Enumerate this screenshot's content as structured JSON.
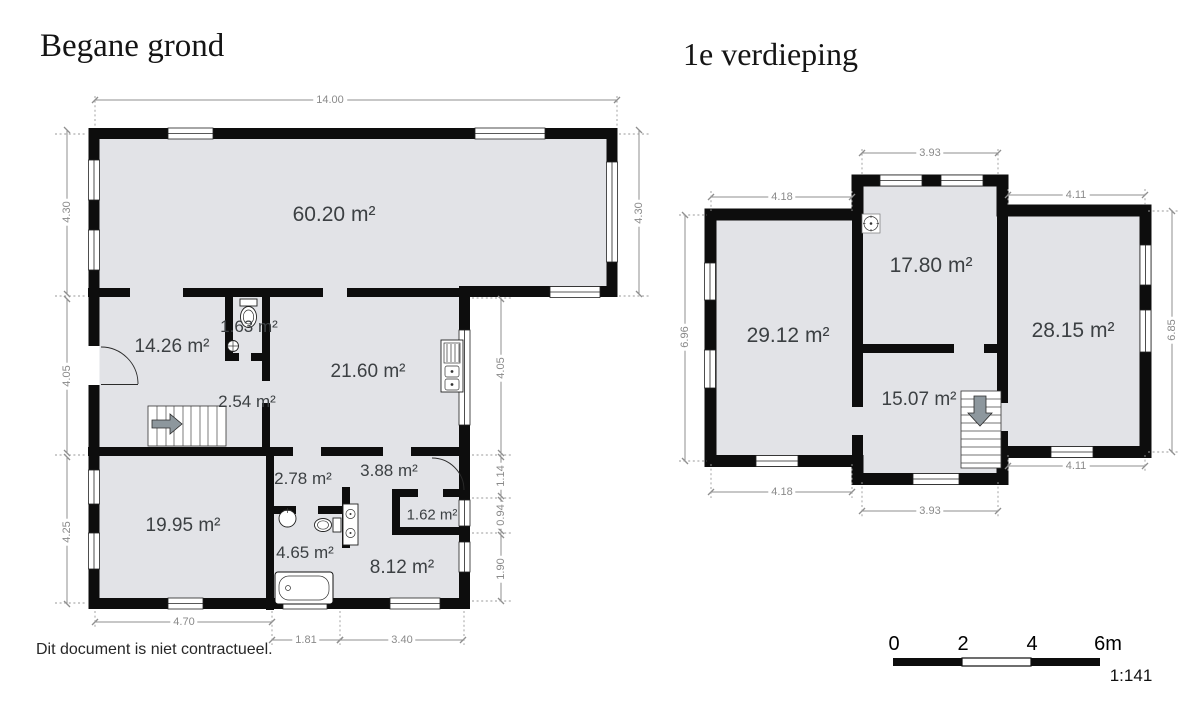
{
  "titles": {
    "ground": "Begane grond",
    "first": "1e verdieping"
  },
  "disclaimer": "Dit document is niet contractueel.",
  "scale_bar": {
    "t0": "0",
    "t2": "2",
    "t4": "4",
    "t6": "6m",
    "ratio": "1:141"
  },
  "colors": {
    "room_fill": "#e2e3e7",
    "wall": "#0d0d0d",
    "dimension": "#8a8a8a"
  },
  "ground_floor": {
    "areas": {
      "living": "60.20 m²",
      "hall": "14.26 m²",
      "wc": "1.63 m²",
      "kitchen": "21.60 m²",
      "stair_closet": "2.54 m²",
      "corridor": "2.78 m²",
      "hallway": "3.88 m²",
      "front_room": "19.95 m²",
      "bathroom": "4.65 m²",
      "closet": "1.62 m²",
      "back_room": "8.12 m²"
    },
    "dims": {
      "top": "14.00",
      "left_top": "4.30",
      "left_mid": "4.05",
      "left_bottom": "4.25",
      "right": "4.30",
      "inner_1": "4.05",
      "inner_2": "1.14",
      "inner_3": "0.94",
      "inner_4": "1.90",
      "bottom_left": "4.70",
      "bottom_mid": "1.81",
      "bottom_right": "3.40"
    }
  },
  "first_floor": {
    "areas": {
      "bedroom_left": "29.12 m²",
      "bedroom_center": "17.80 m²",
      "bedroom_right": "28.15 m²",
      "landing": "15.07 m²"
    },
    "dims": {
      "top_center": "3.93",
      "top_left": "4.18",
      "top_right": "4.11",
      "left": "6.96",
      "right": "6.85",
      "bottom_left": "4.18",
      "bottom_center": "3.93",
      "bottom_right": "4.11"
    }
  }
}
